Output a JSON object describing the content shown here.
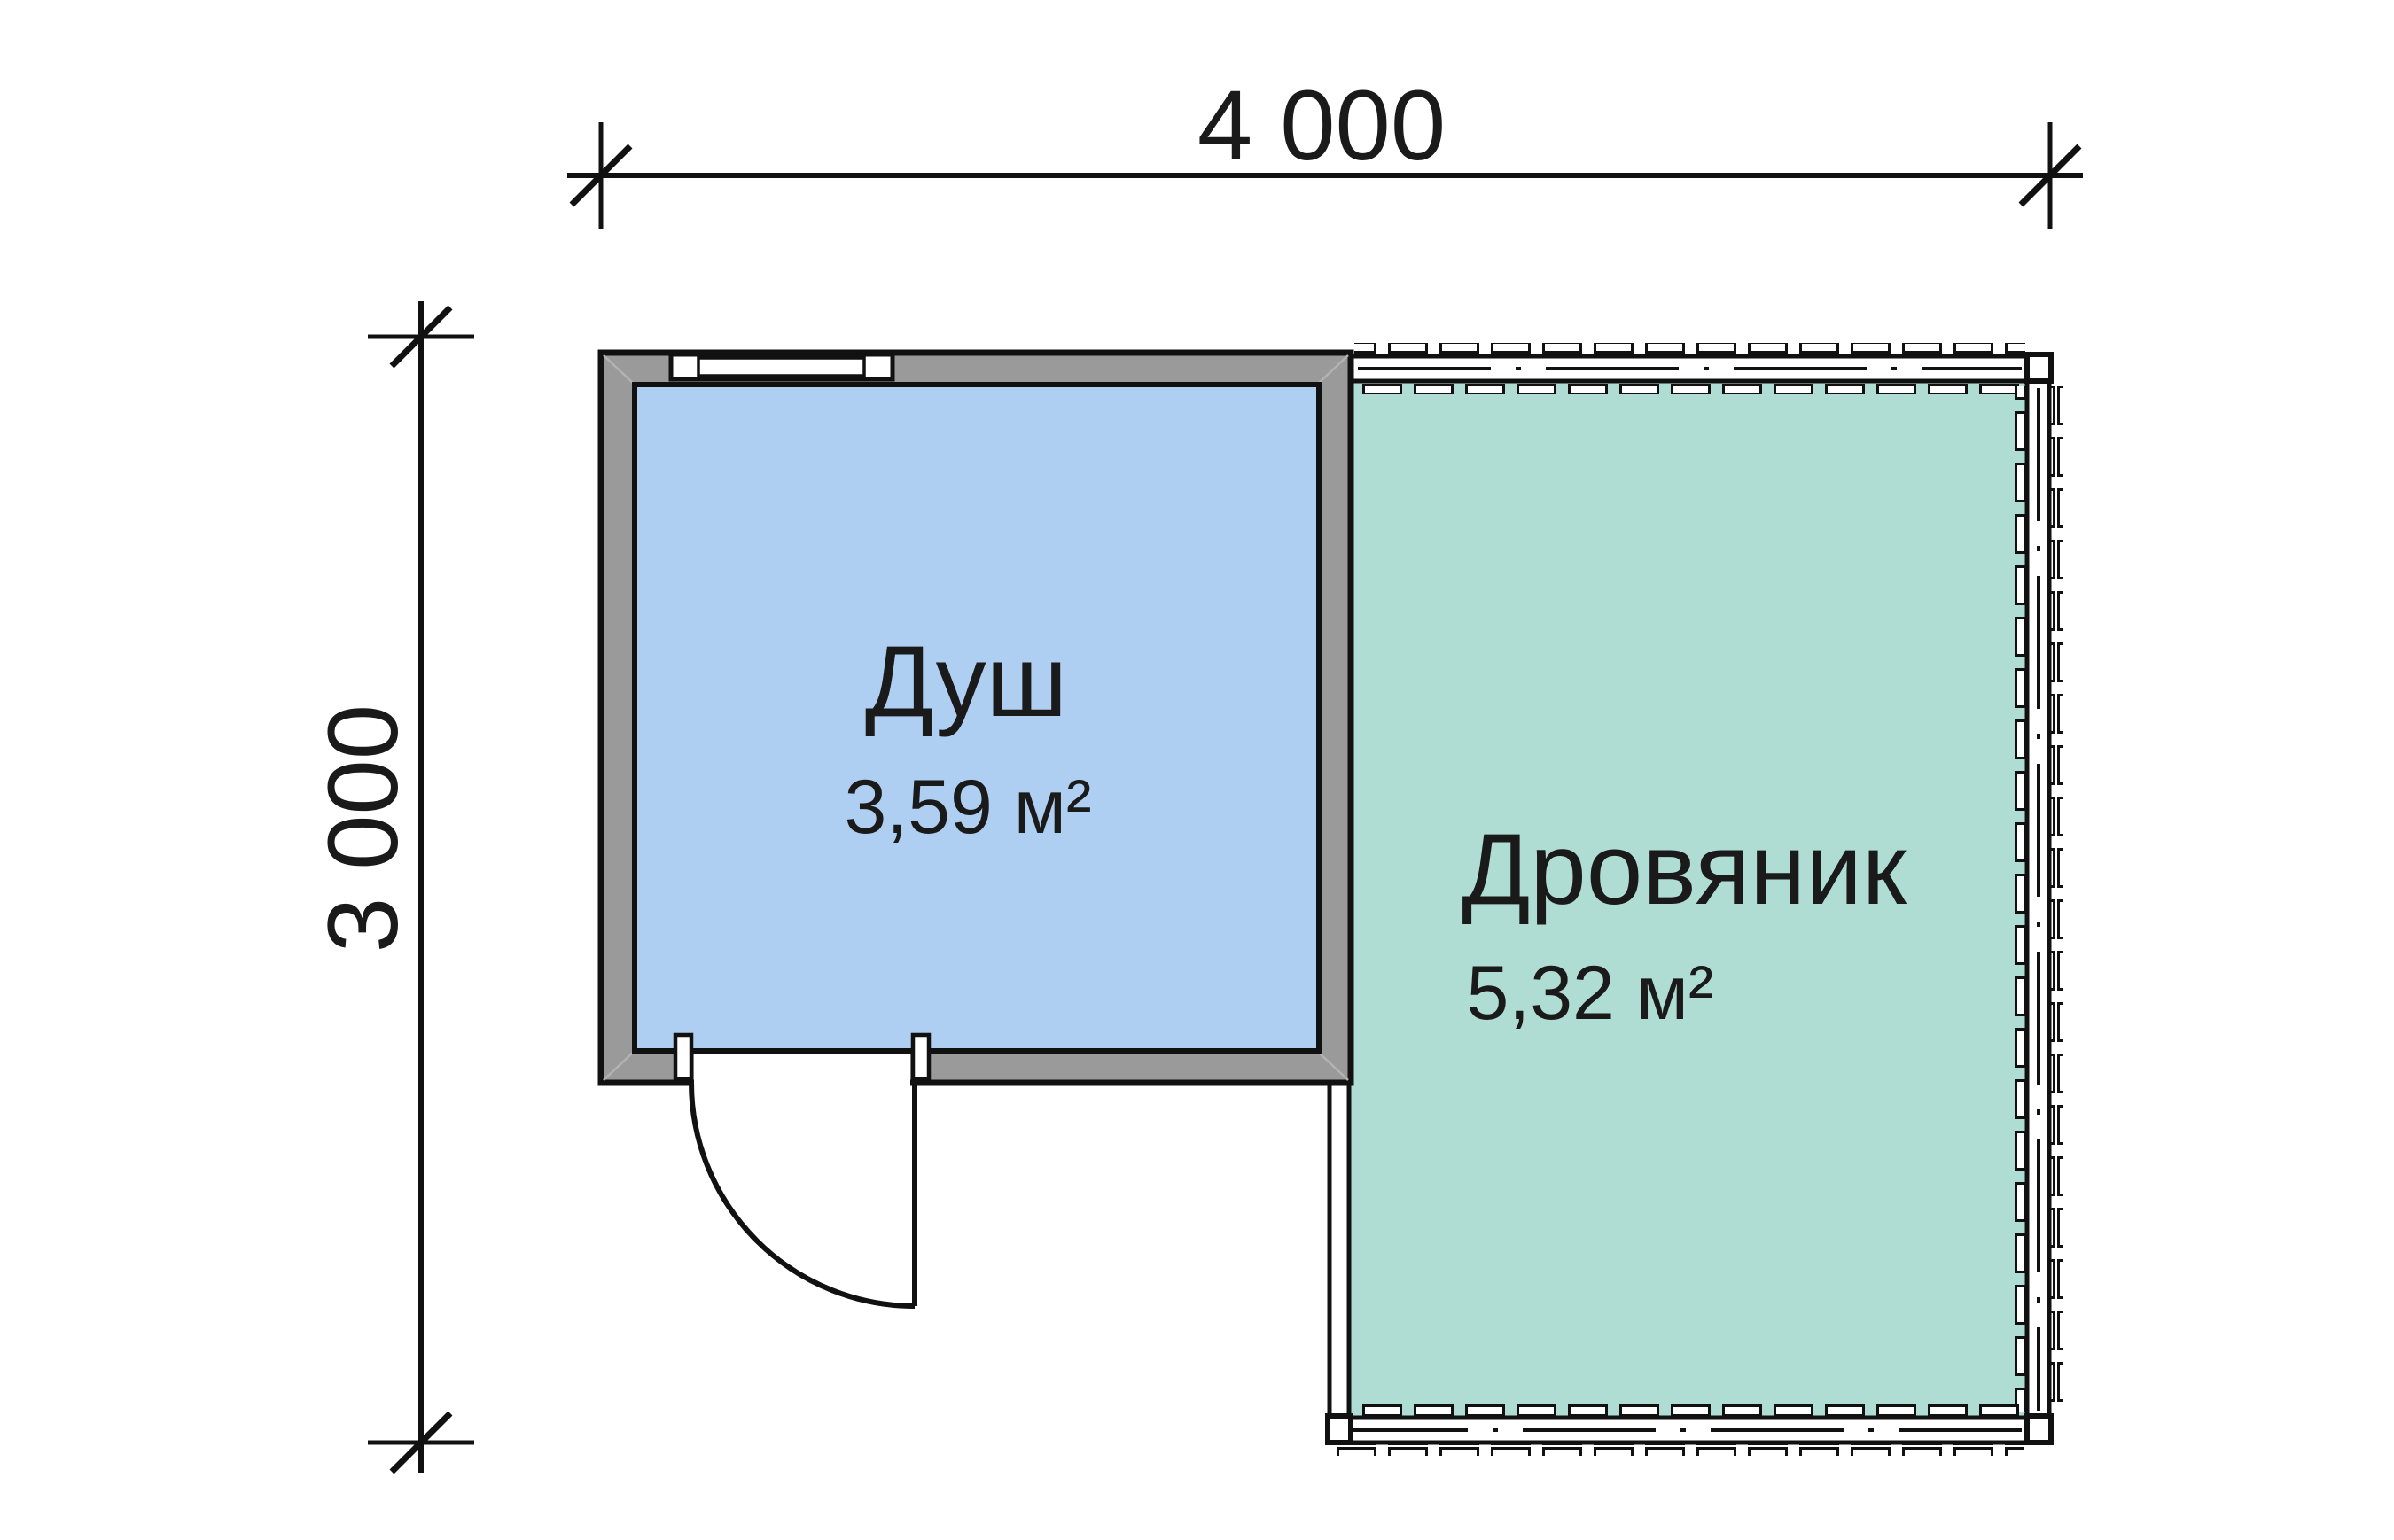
{
  "page": {
    "background": "#ffffff",
    "line_color": "#111111",
    "text_color": "#1a1a1a",
    "wall_fill": "#9a9a9a"
  },
  "dimension_top": {
    "label": "4 000"
  },
  "dimension_left": {
    "label": "3 000"
  },
  "rooms": {
    "shower": {
      "name": "Душ",
      "area": "3,59 м²",
      "fill": "#aecef2"
    },
    "woodshed": {
      "name": "Дровяник",
      "area": "5,32 м²",
      "fill": "#afddd3"
    }
  }
}
